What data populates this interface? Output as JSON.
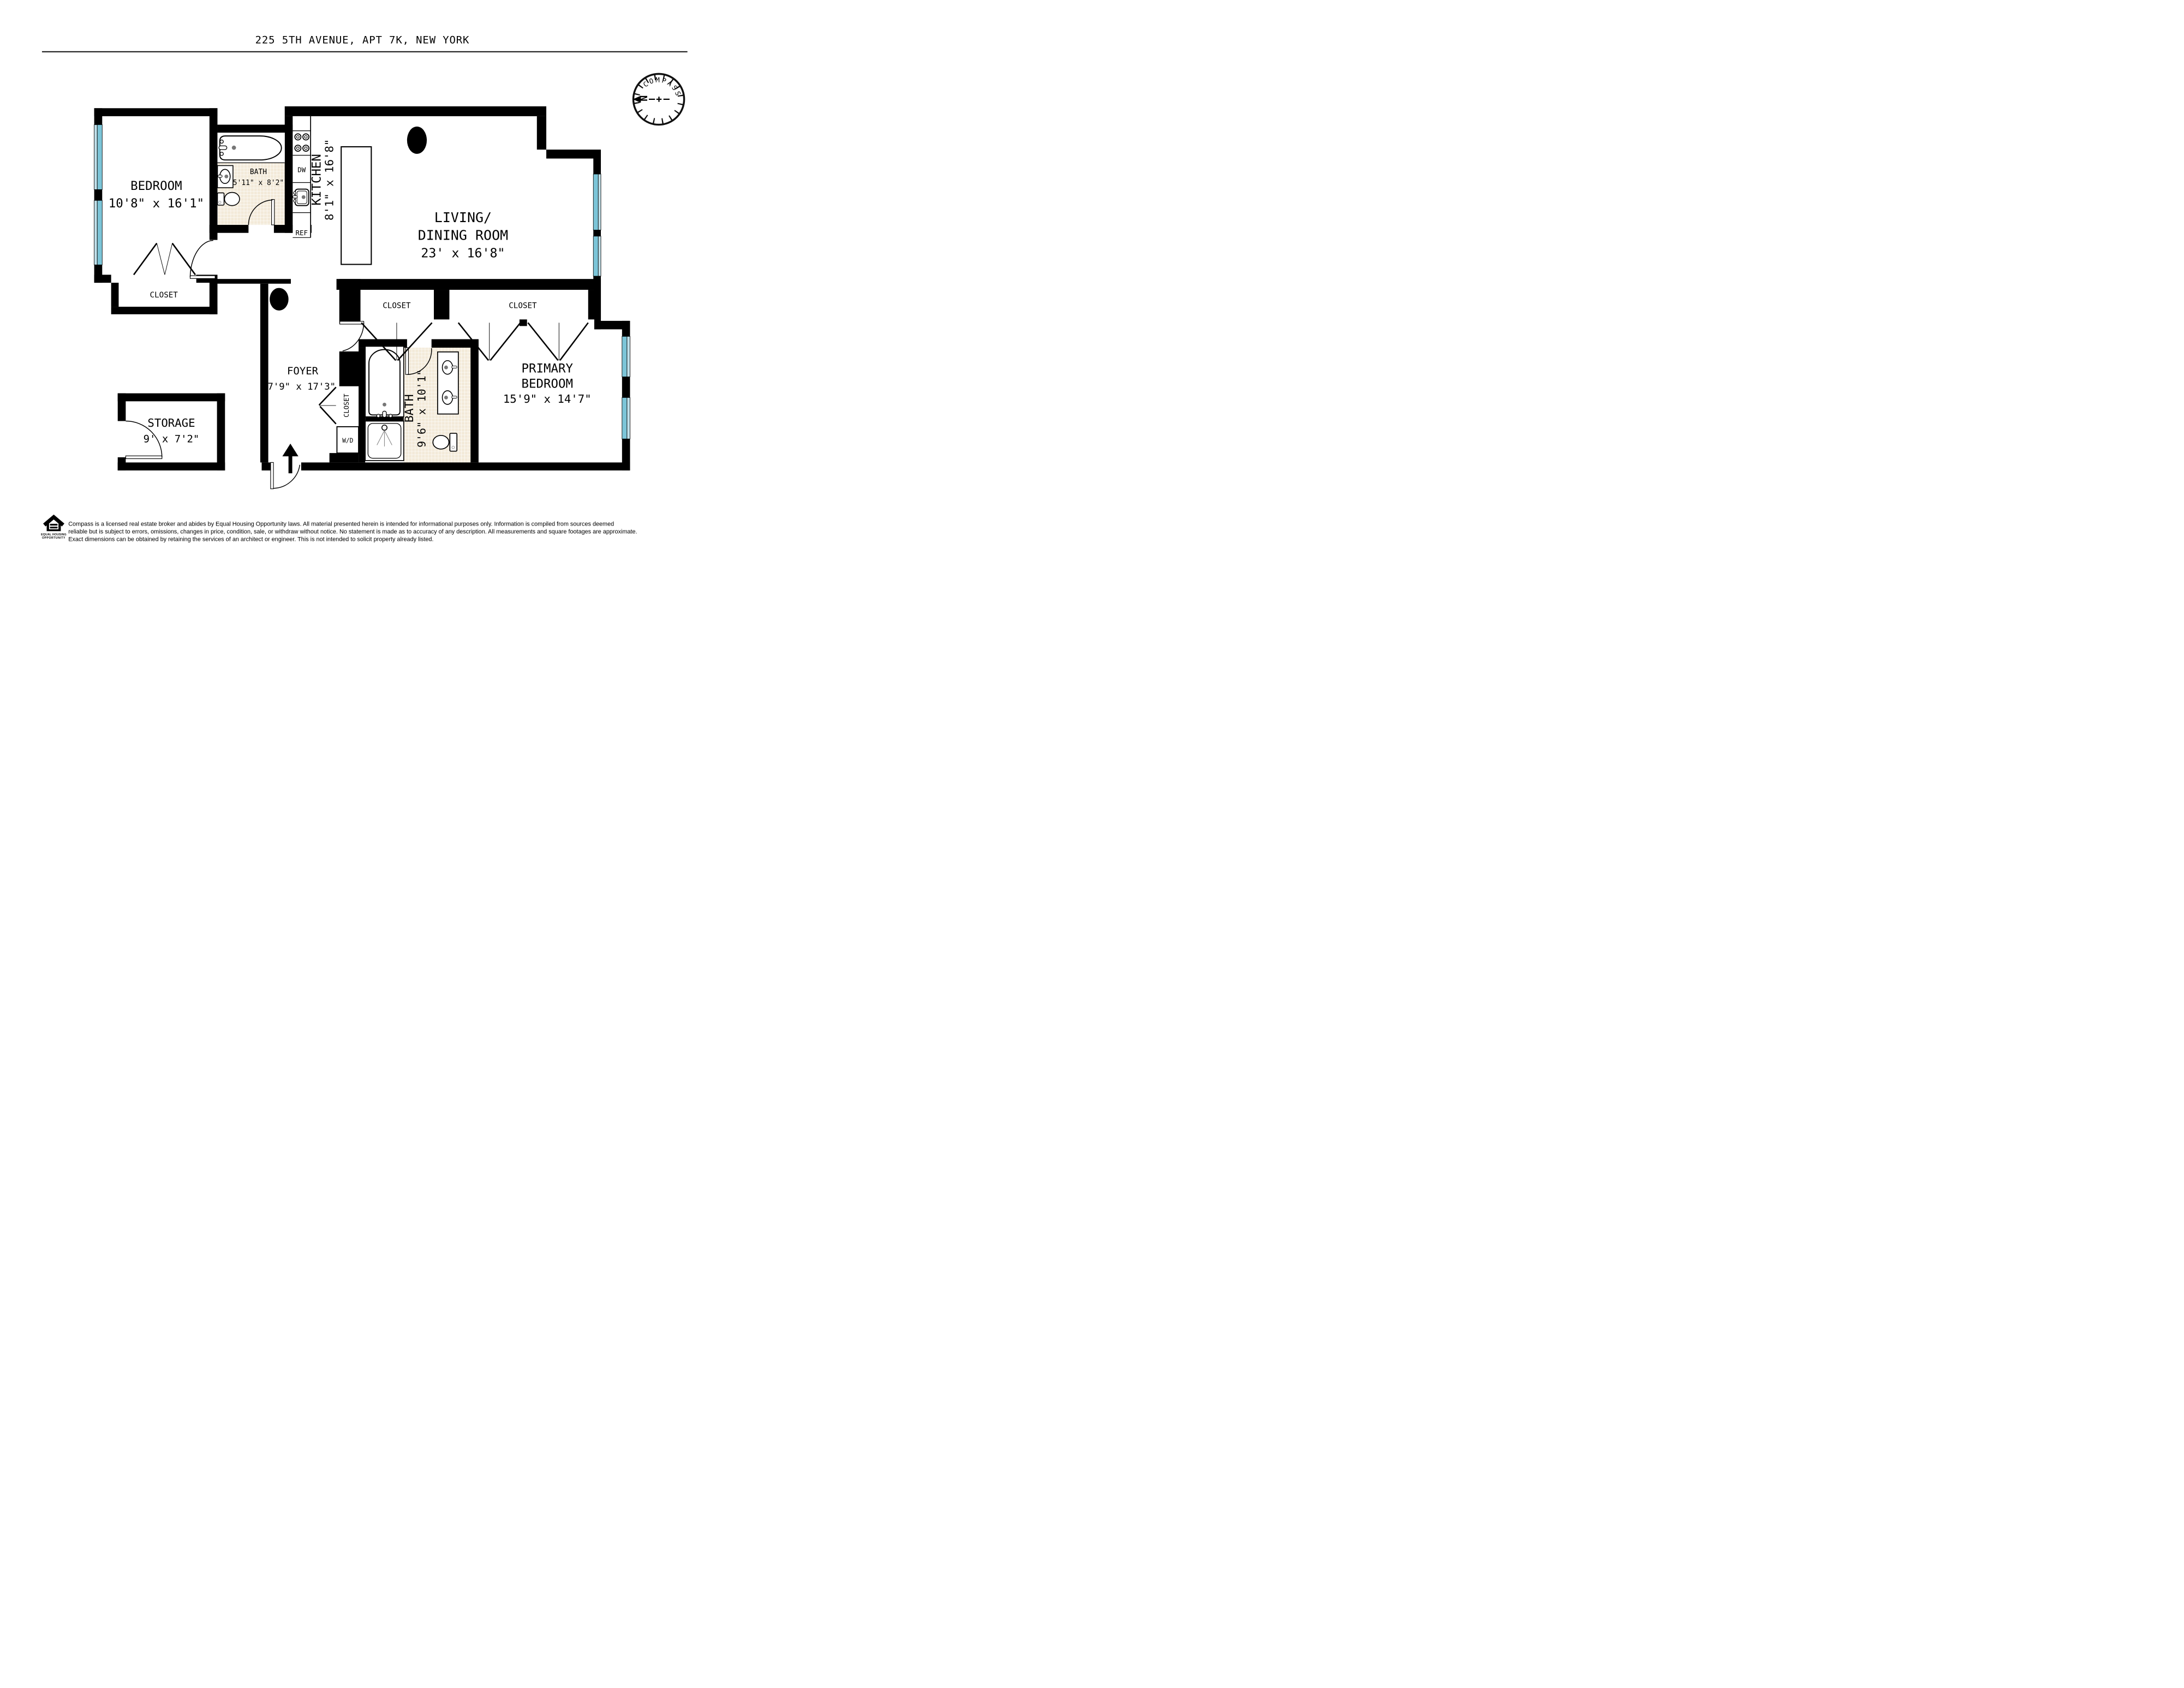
{
  "title": "225 5TH AVENUE, APT 7K, NEW YORK",
  "compass": {
    "label": "COMPASS",
    "north": "N"
  },
  "rooms": {
    "bedroom": {
      "name": "BEDROOM",
      "dims": "10'8\" x 16'1\""
    },
    "bath1": {
      "name": "BATH",
      "dims": "5'11\" x 8'2\""
    },
    "kitchen": {
      "name": "KITCHEN",
      "dims": "8'1\" x 16'8\""
    },
    "living": {
      "name_line1": "LIVING/",
      "name_line2": "DINING ROOM",
      "dims": "23' x 16'8\""
    },
    "foyer": {
      "name": "FOYER",
      "dims": "7'9\" x 17'3\""
    },
    "storage": {
      "name": "STORAGE",
      "dims": "9' x 7'2\""
    },
    "primary": {
      "name_line1": "PRIMARY",
      "name_line2": "BEDROOM",
      "dims": "15'9\" x 14'7\""
    },
    "bath2": {
      "name": "BATH",
      "dims": "9'6\" x 10'1\""
    }
  },
  "closets": {
    "bedroom_closet": "CLOSET",
    "hall_closet_left": "CLOSET",
    "hall_closet_right": "CLOSET",
    "foyer_closet": "CLOSET"
  },
  "appliances": {
    "dishwasher": "DW",
    "refrigerator": "REF",
    "washer_dryer": "W/D"
  },
  "footer": {
    "logo_line1": "EQUAL HOUSING",
    "logo_line2": "OPPORTUNITY",
    "disclaimer_line1": "Compass is a licensed real estate broker and abides by Equal Housing Opportunity laws. All material presented herein is intended for informational purposes only. Information is compiled from sources deemed",
    "disclaimer_line2": "reliable but is subject to errors, omissions, changes in price, condition, sale, or withdraw without notice. No statement is made as to accuracy of any description. All measurements and square footages are approximate.",
    "disclaimer_line3": "Exact dimensions can be obtained by retaining the services of an architect or engineer. This is not intended to solicit property already listed."
  },
  "colors": {
    "wall": "#000000",
    "window_glass": "#7cc5d8",
    "window_glass_light": "#bfe0ea",
    "tile": "#f3ead9",
    "north_red": "#e8312a"
  }
}
